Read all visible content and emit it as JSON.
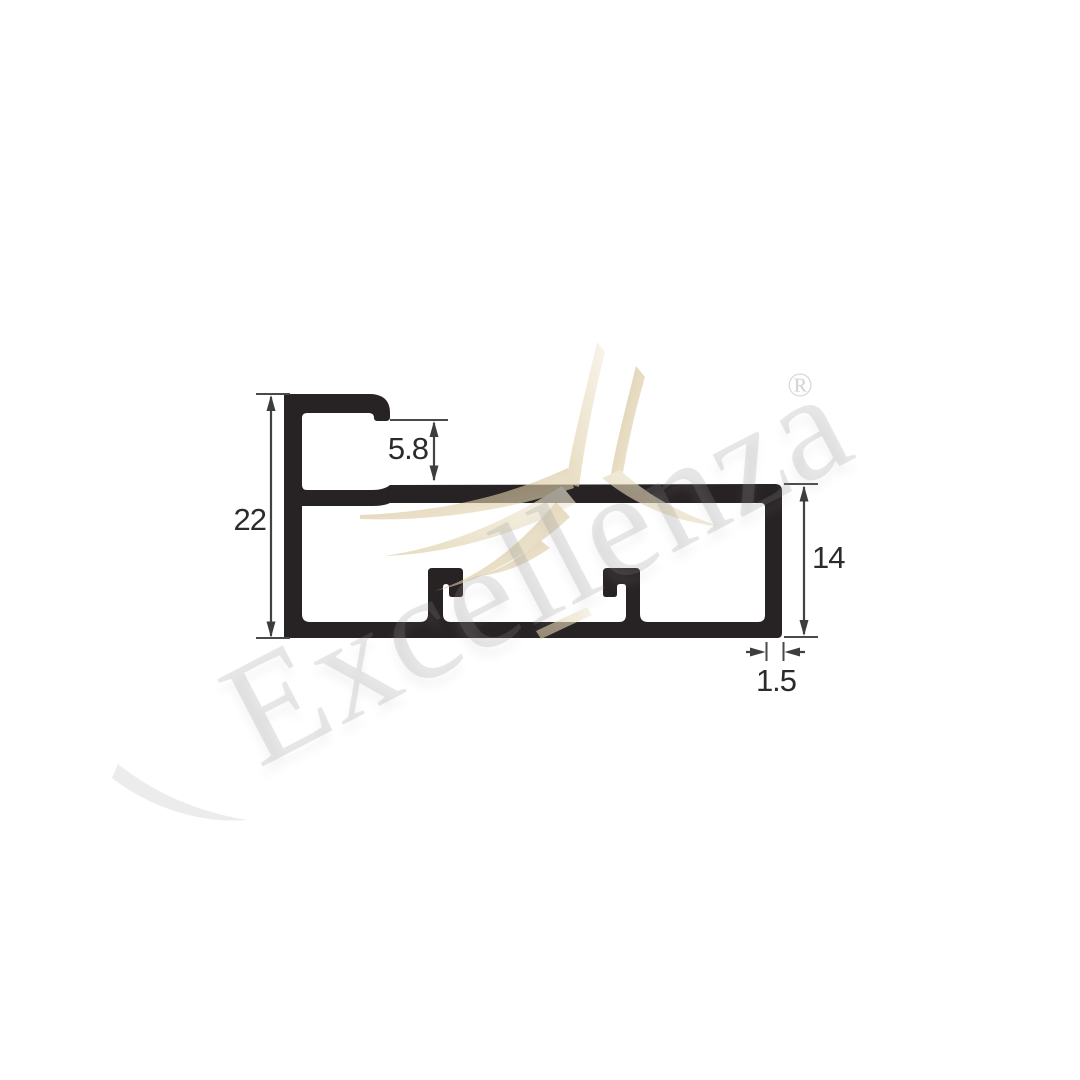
{
  "watermark": {
    "brand": "Excellenza",
    "registered": "®"
  },
  "dimensions": {
    "overall_height_mm": "22",
    "lip_offset_mm": "5.8",
    "box_height_mm": "14",
    "wall_thickness_mm": "1.5"
  },
  "colors": {
    "profile": "#272223",
    "dimension_lines": "#424242",
    "dimension_text": "#2d2a2b",
    "gold_accent": "#cdb67f",
    "watermark_gray": "#e9e9e9",
    "background": "#ffffff"
  }
}
